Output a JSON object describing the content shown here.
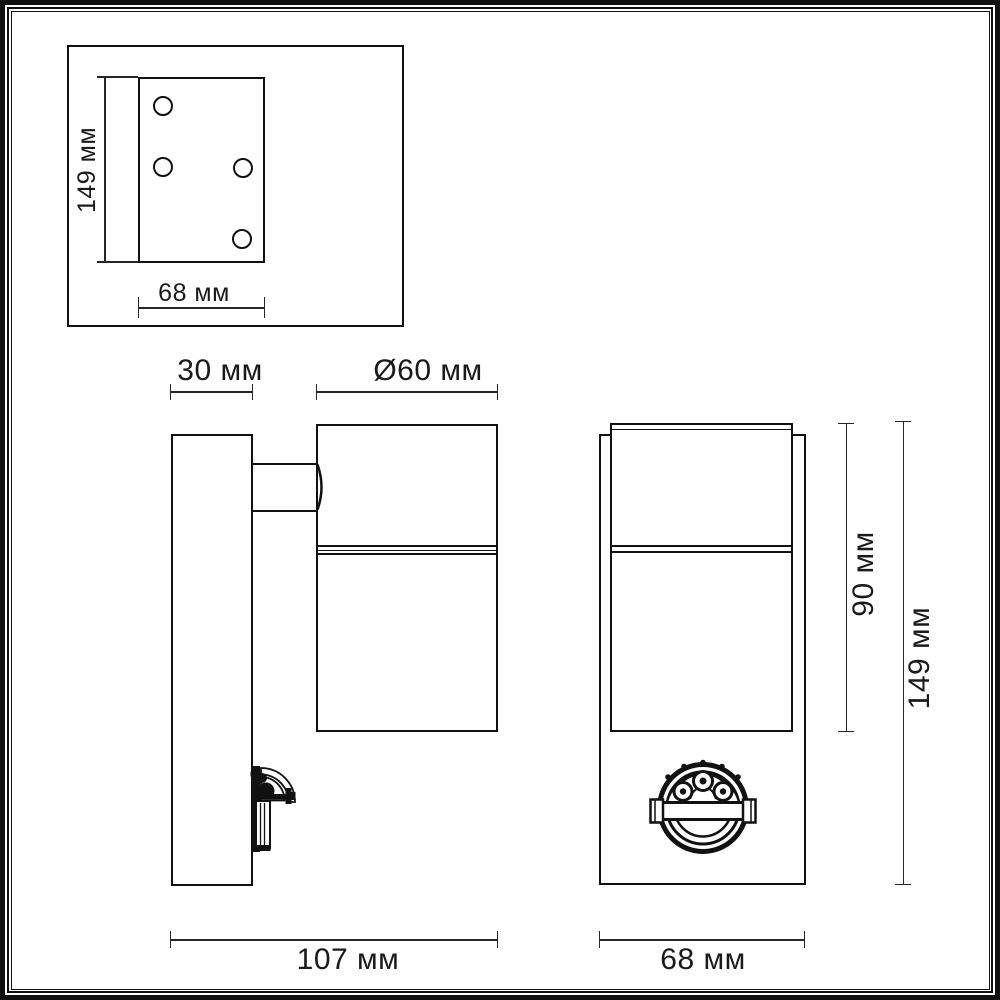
{
  "drawing": {
    "title": "wall-luminaire-dimension-drawing",
    "unit": "мм",
    "colors": {
      "line": "#111111",
      "dimension_line": "#262626",
      "background": "#ffffff",
      "text": "#1a1a1a"
    },
    "inset_view": {
      "height_dim": "149 мм",
      "width_dim": "68 мм",
      "hole_count": 4
    },
    "side_view": {
      "bracket_depth_dim": "30 мм",
      "diameter_dim": "Ø60 мм",
      "overall_depth_dim": "107 мм"
    },
    "front_view": {
      "body_height_dim": "90 мм",
      "overall_height_dim": "149 мм",
      "width_dim": "68 мм"
    }
  }
}
